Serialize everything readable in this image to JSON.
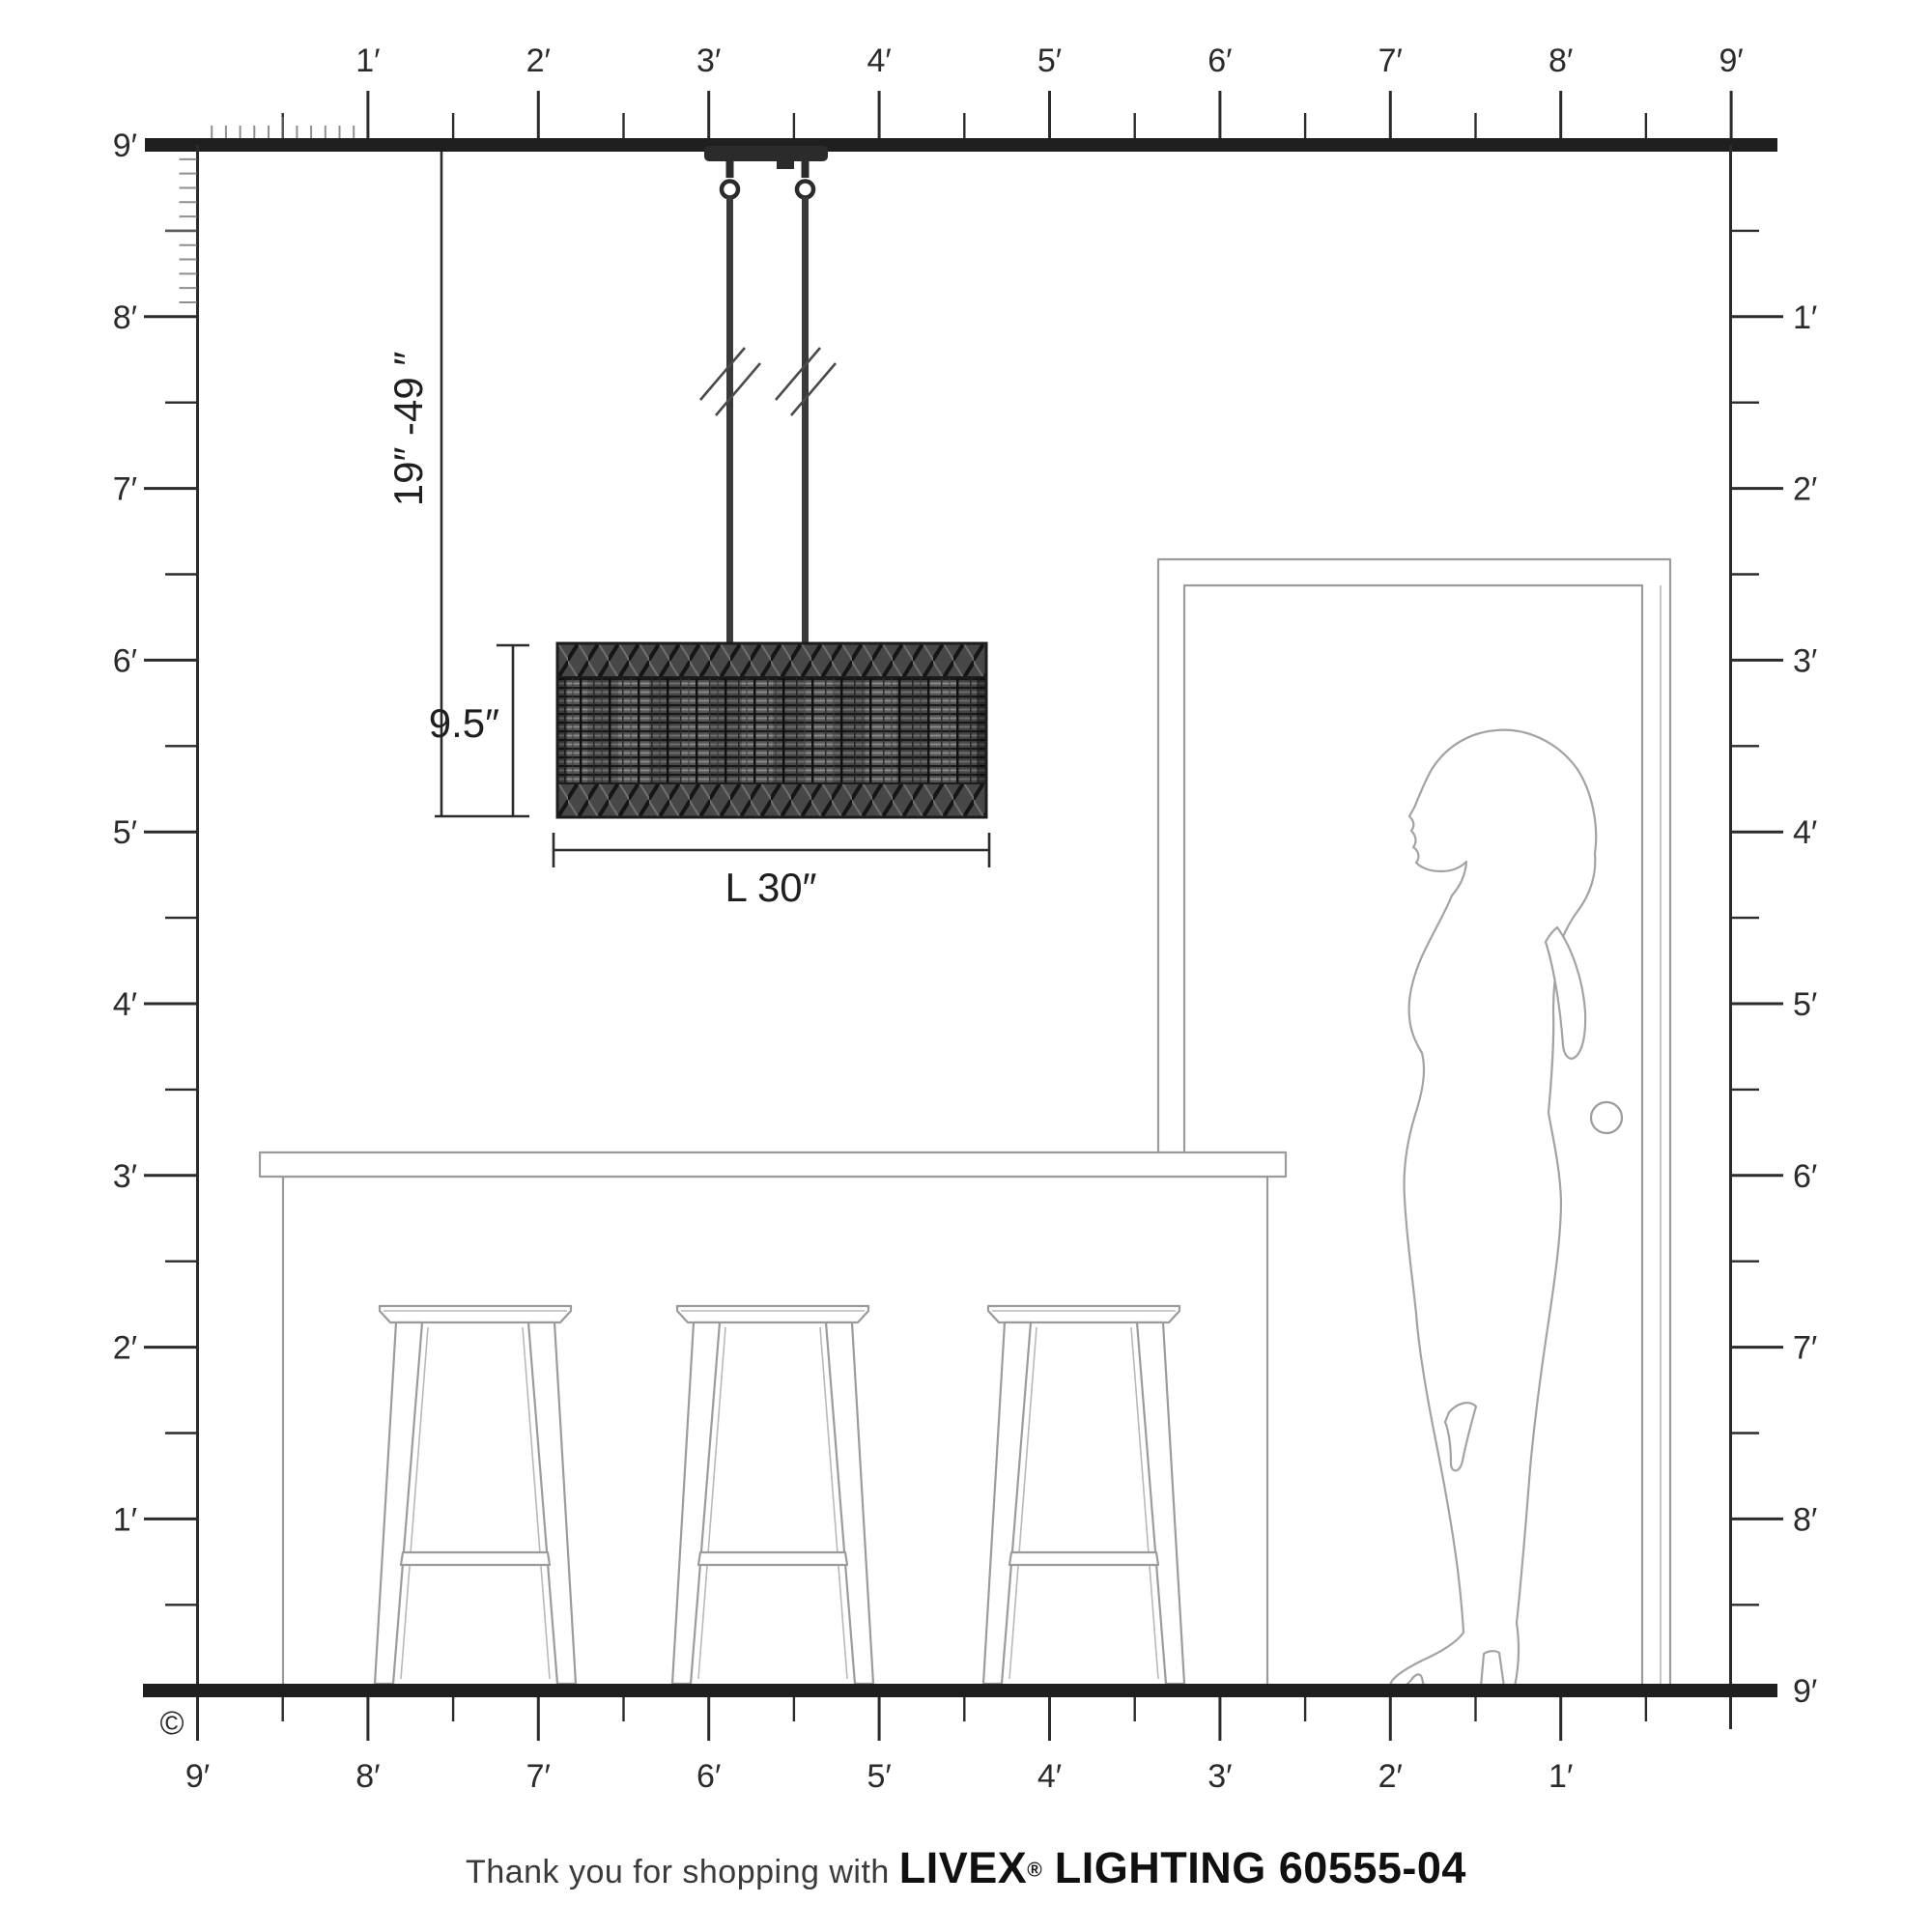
{
  "footer": {
    "prefix": "Thank you for shopping with ",
    "brand": "LIVEX",
    "reg": "®",
    "suffix": " LIGHTING 60555-04"
  },
  "copyright": "©",
  "pendant_dims": {
    "drop": "19″ -49 ″",
    "shade_height": "9.5″",
    "shade_length": "L 30″"
  },
  "rulers": {
    "top": [
      "1′",
      "2′",
      "3′",
      "4′",
      "5′",
      "6′",
      "7′",
      "8′",
      "9′"
    ],
    "left_ceiling": "9′",
    "left": [
      "8′",
      "7′",
      "6′",
      "5′",
      "4′",
      "3′",
      "2′",
      "1′"
    ],
    "right": [
      "1′",
      "2′",
      "3′",
      "4′",
      "5′",
      "6′",
      "7′",
      "8′"
    ],
    "right_floor": "9′",
    "bottom": [
      "9′",
      "8′",
      "7′",
      "6′",
      "5′",
      "4′",
      "3′",
      "2′",
      "1′"
    ]
  },
  "colors": {
    "ink": "#2b2b2b",
    "furniture_line": "#9b9b9b",
    "shade_dark": "#474747"
  }
}
